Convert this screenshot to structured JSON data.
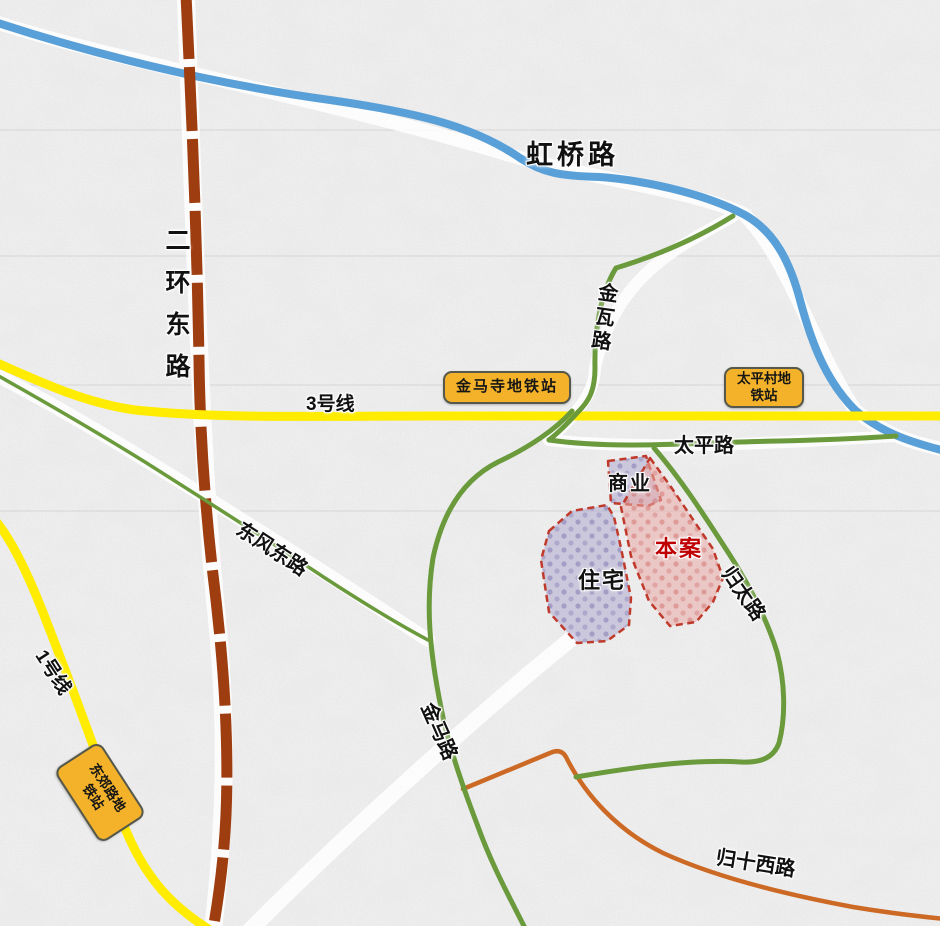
{
  "map": {
    "description_labels": {
      "commercial": "商业",
      "residential": "住宅",
      "site": "本案"
    },
    "roads": {
      "hongqiao": {
        "label": "虹桥路",
        "color": "#5aa0d8"
      },
      "erhuandong": {
        "label": "二环东路",
        "color": "#9e3d10"
      },
      "jinwa": {
        "label": "金瓦路",
        "color": "#6a9a3c"
      },
      "taiping": {
        "label": "太平路",
        "color": "#6a9a3c"
      },
      "jinma": {
        "label": "金马路",
        "color": "#6a9a3c"
      },
      "dongfengdong": {
        "label": "东风东路",
        "color": "#6a9a3c"
      },
      "guitai": {
        "label": "归太路",
        "color": "#6a9a3c"
      },
      "guishixi": {
        "label": "归十西路",
        "color": "#cc6a25"
      }
    },
    "metro": {
      "line3": {
        "label": "3号线",
        "color": "#ffec00"
      },
      "line1": {
        "label": "1号线",
        "color": "#ffec00"
      }
    },
    "stations": {
      "jinmasi": {
        "label": "金马寺地铁站",
        "fill": "#f3b229"
      },
      "taipingcun": {
        "line1": "太平村地",
        "line2": "铁站",
        "fill": "#f3b229"
      },
      "dongjiaolu": {
        "line1": "东郊路地",
        "line2": "铁站",
        "fill": "#f3b229"
      }
    },
    "areas": {
      "commercial": {
        "label": "商业",
        "fill": "#a9a2cc",
        "border": "#c03a2b",
        "text_color": "#111111"
      },
      "residential": {
        "label": "住宅",
        "fill": "#a9a2cc",
        "border": "#c03a2b",
        "text_color": "#111111"
      },
      "site": {
        "label": "本案",
        "fill": "#e9a9a6",
        "border": "#c03a2b",
        "text_color": "#c00000"
      }
    }
  }
}
